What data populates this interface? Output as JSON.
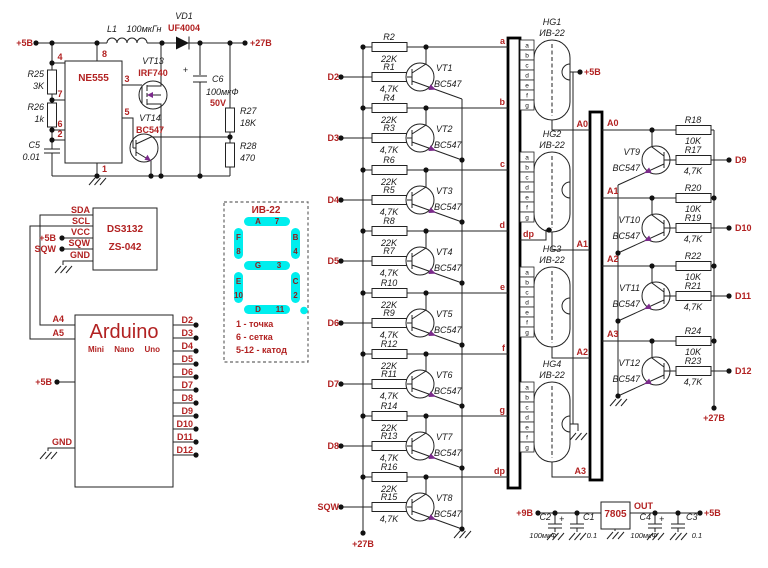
{
  "colors": {
    "accent_red": "#B22222",
    "segment_cyan": "#00EEEE",
    "arrow_purple": "#7B2A8B",
    "wire": "#222222"
  },
  "boost": {
    "vin": "+5В",
    "vout": "+27В",
    "l1": "L1",
    "l1_val": "100мкГн",
    "vd1": "VD1",
    "vd1_val": "UF4004",
    "ic": "NE555",
    "p4": "4",
    "p8": "8",
    "p7": "7",
    "p6": "6",
    "p2": "2",
    "p1": "1",
    "p3": "3",
    "p5": "5",
    "r25": "R25",
    "r25_val": "3K",
    "r26": "R26",
    "r26_val": "1k",
    "c5": "C5",
    "c5_val": "0.01",
    "vt13": "VT13",
    "vt13_val": "IRF740",
    "vt14": "VT14",
    "vt14_val": "BC547",
    "c6": "C6",
    "c6_val": "100мкФ",
    "c6_v": "50V",
    "r27": "R27",
    "r27_val": "18K",
    "r28": "R28",
    "r28_val": "470"
  },
  "rtc": {
    "ic": "DS3132",
    "module": "ZS-042",
    "pins": [
      "SDA",
      "SCL",
      "VCC",
      "SQW",
      "GND"
    ],
    "vcc_label": "+5В",
    "sqw_label": "SQW"
  },
  "arduino": {
    "name": "Arduino",
    "variants": "Mini Nano Uno",
    "a4": "A4",
    "a5": "A5",
    "vcc": "+5В",
    "gnd": "GND",
    "dpins": [
      "D2",
      "D3",
      "D4",
      "D5",
      "D6",
      "D7",
      "D8",
      "D9",
      "D10",
      "D11",
      "D12"
    ]
  },
  "legend": {
    "title": "ИВ-22",
    "segments": [
      {
        "l": "A",
        "n": "7"
      },
      {
        "l": "F",
        "n": "8"
      },
      {
        "l": "B",
        "n": "4"
      },
      {
        "l": "G",
        "n": "3"
      },
      {
        "l": "E",
        "n": "10"
      },
      {
        "l": "C",
        "n": "2"
      },
      {
        "l": "D",
        "n": "11"
      }
    ],
    "notes": [
      "1 - точка",
      "6 - сетка",
      "5-12 - катод"
    ]
  },
  "drivers": {
    "rail": "+27В",
    "stages": [
      {
        "r_top": "R2",
        "r_top_val": "22K",
        "r_bot": "R1",
        "r_bot_val": "4,7K",
        "vt": "VT1",
        "vt_val": "BC547",
        "input": "D2",
        "output": "a"
      },
      {
        "r_top": "R4",
        "r_top_val": "22K",
        "r_bot": "R3",
        "r_bot_val": "4,7K",
        "vt": "VT2",
        "vt_val": "BC547",
        "input": "D3",
        "output": "b"
      },
      {
        "r_top": "R6",
        "r_top_val": "22K",
        "r_bot": "R5",
        "r_bot_val": "4,7K",
        "vt": "VT3",
        "vt_val": "BC547",
        "input": "D4",
        "output": "c"
      },
      {
        "r_top": "R8",
        "r_top_val": "22K",
        "r_bot": "R7",
        "r_bot_val": "4,7K",
        "vt": "VT4",
        "vt_val": "BC547",
        "input": "D5",
        "output": "d"
      },
      {
        "r_top": "R10",
        "r_top_val": "22K",
        "r_bot": "R9",
        "r_bot_val": "4,7K",
        "vt": "VT5",
        "vt_val": "BC547",
        "input": "D6",
        "output": "e"
      },
      {
        "r_top": "R12",
        "r_top_val": "22K",
        "r_bot": "R11",
        "r_bot_val": "4,7K",
        "vt": "VT6",
        "vt_val": "BC547",
        "input": "D7",
        "output": "f"
      },
      {
        "r_top": "R14",
        "r_top_val": "22K",
        "r_bot": "R13",
        "r_bot_val": "4,7K",
        "vt": "VT7",
        "vt_val": "BC547",
        "input": "D8",
        "output": "g"
      },
      {
        "r_top": "R16",
        "r_top_val": "22K",
        "r_bot": "R15",
        "r_bot_val": "4,7K",
        "vt": "VT8",
        "vt_val": "BC547",
        "input": "SQW",
        "output": "dp"
      }
    ]
  },
  "tubes": {
    "pins": [
      "a",
      "b",
      "c",
      "d",
      "e",
      "f",
      "g"
    ],
    "dp": "dp",
    "heater": "+5В",
    "units": [
      {
        "ref": "HG1",
        "type": "ИВ-22",
        "grid": "A0"
      },
      {
        "ref": "HG2",
        "type": "ИВ-22",
        "grid": "A1"
      },
      {
        "ref": "HG3",
        "type": "ИВ-22",
        "grid": "A2"
      },
      {
        "ref": "HG4",
        "type": "ИВ-22",
        "grid": "A3"
      }
    ]
  },
  "grid_drivers": {
    "rail": "+27В",
    "stages": [
      {
        "r_top": "R18",
        "r_top_val": "10K",
        "r_bot": "R17",
        "r_bot_val": "4,7K",
        "vt": "VT9",
        "vt_val": "BC547",
        "input": "A0",
        "output": "D9"
      },
      {
        "r_top": "R20",
        "r_top_val": "10K",
        "r_bot": "R19",
        "r_bot_val": "4,7K",
        "vt": "VT10",
        "vt_val": "BC547",
        "input": "A1",
        "output": "D10"
      },
      {
        "r_top": "R22",
        "r_top_val": "10K",
        "r_bot": "R21",
        "r_bot_val": "4,7K",
        "vt": "VT11",
        "vt_val": "BC547",
        "input": "A2",
        "output": "D11"
      },
      {
        "r_top": "R24",
        "r_top_val": "10K",
        "r_bot": "R23",
        "r_bot_val": "4,7K",
        "vt": "VT12",
        "vt_val": "BC547",
        "input": "A3",
        "output": "D12"
      }
    ]
  },
  "psu": {
    "vin": "+9В",
    "vout": "+5В",
    "reg": "7805",
    "out": "OUT",
    "plus": "+",
    "c2": "C2",
    "c2_val": "100мкФ",
    "c1": "C1",
    "c1_val": "0.1",
    "c4": "C4",
    "c4_val": "100мкФ",
    "c3": "C3",
    "c3_val": "0.1"
  }
}
